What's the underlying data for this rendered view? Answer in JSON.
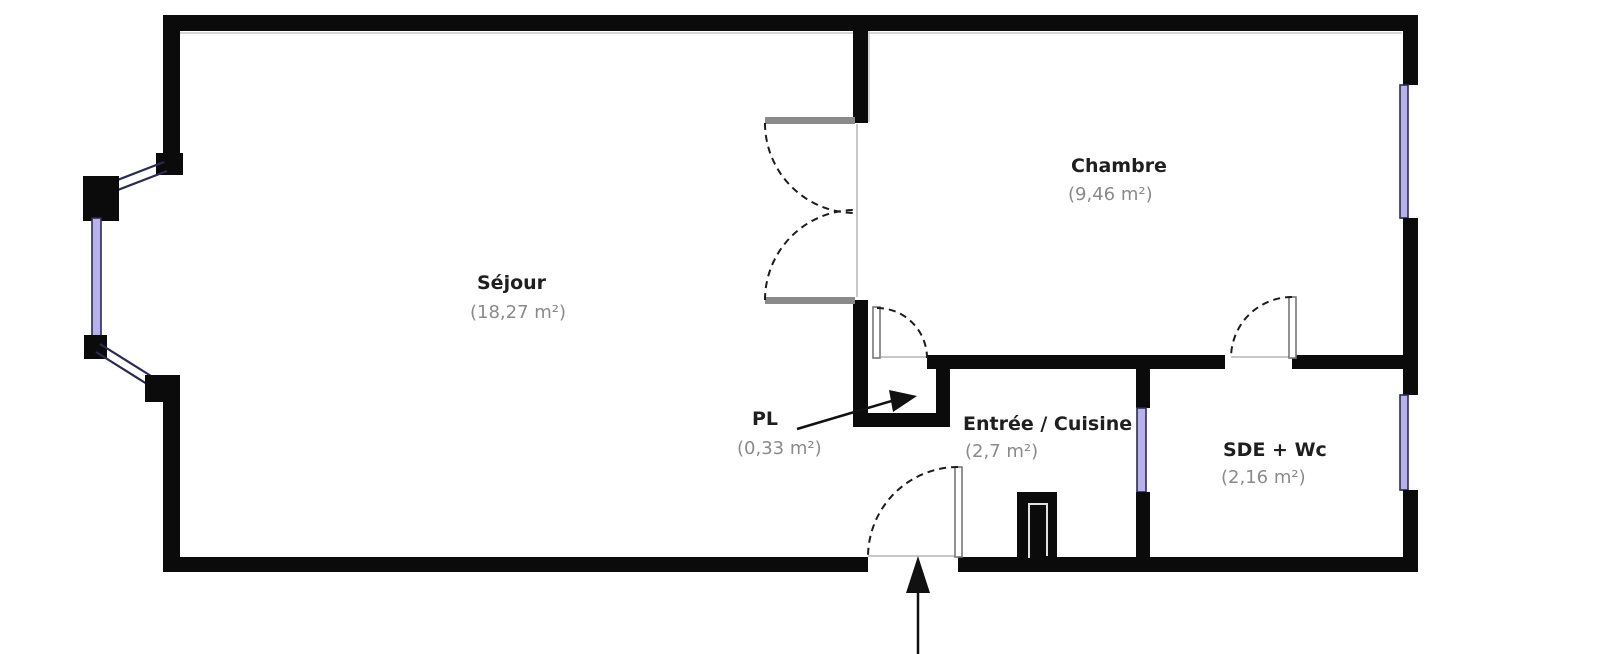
{
  "plan_title": "Apartment floor plan",
  "colors": {
    "wall": "#0b0b0b",
    "window_fill": "#b9b1ea",
    "window_frame": "#2a2a55",
    "door_leaf": "#8a8a8a",
    "arc": "#1c1c1c",
    "opening": "#c8c8c8",
    "room_name": "#1f1f1f",
    "room_area": "#8a8a8a",
    "background": "#ffffff"
  },
  "rooms": [
    {
      "name": "Séjour",
      "area": "(18,27 m²)"
    },
    {
      "name": "Chambre",
      "area": "(9,46 m²)"
    },
    {
      "name": "PL",
      "area": "(0,33 m²)"
    },
    {
      "name": "Entrée / Cuisine",
      "area": "(2,7 m²)"
    },
    {
      "name": "SDE + Wc",
      "area": "(2,16 m²)"
    }
  ],
  "markers": {
    "entrance_arrow": "entrance",
    "pl_arrow": "points to closet"
  }
}
